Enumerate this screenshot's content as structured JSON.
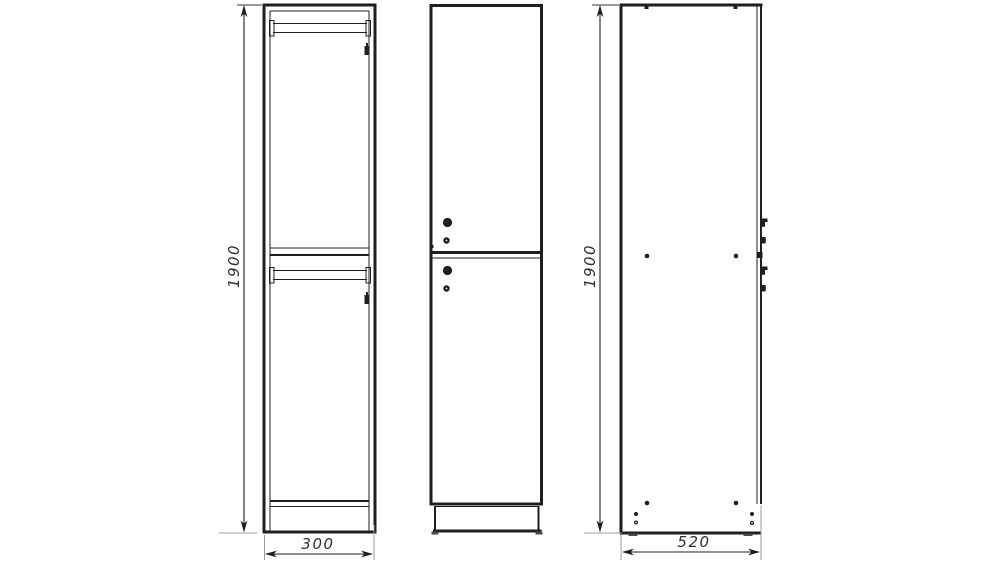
{
  "drawing": {
    "kind": "cabinet-three-view-technical-drawing",
    "dimensions": {
      "front_height": "1900",
      "front_width": "300",
      "side_height": "1900",
      "side_depth": "520"
    },
    "colors": {
      "line": "#1f1f1f",
      "extension_line": "#9b9b9b",
      "dimension_text": "#2e2e2e",
      "background": "#ffffff"
    }
  }
}
